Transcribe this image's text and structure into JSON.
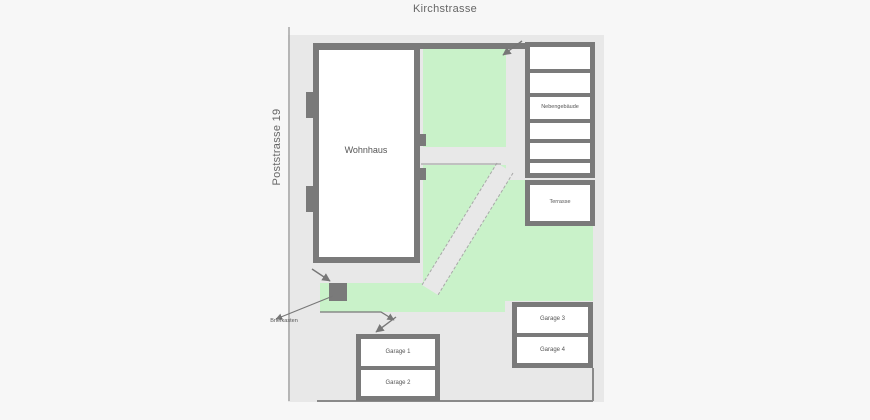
{
  "plan": {
    "streets": {
      "top": "Kirchstrasse",
      "left": "Poststrasse 19"
    },
    "buildings": {
      "wohnhaus": "Wohnhaus",
      "nebengebaeude": "Nebengebäude",
      "terrasse": "Terrasse",
      "garage1": "Garage 1",
      "garage2": "Garage 2",
      "garage3": "Garage 3",
      "garage4": "Garage 4"
    },
    "annotations": {
      "briefkasten": "Briefkasten"
    },
    "colors": {
      "page_bg": "#f7f7f7",
      "site_fill": "#e8e8e8",
      "lawn": "#c9f2c9",
      "building_border": "#7a7a7a",
      "building_fill": "#ffffff",
      "line": "#8f8f8f"
    }
  }
}
